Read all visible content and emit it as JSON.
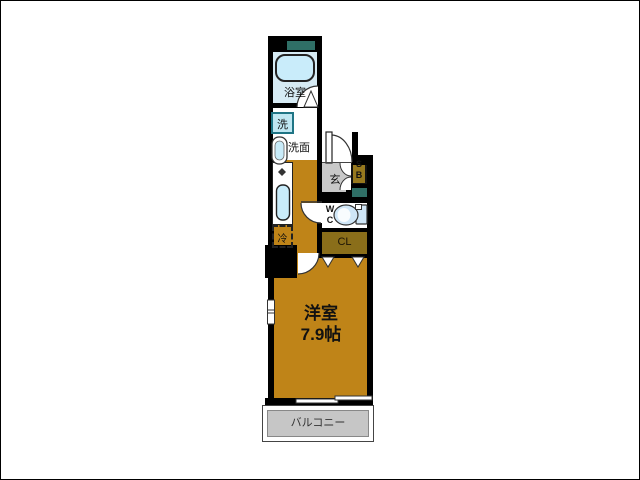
{
  "colors": {
    "wall": "#000000",
    "floor_orange": "#bf8418",
    "bathroom_blue": "#d6ebf4",
    "fixture_blue": "#c9ecfa",
    "washer_blue": "#bfe7f2",
    "washer_border": "#1f7585",
    "genkan_gray": "#c8c8c8",
    "balcony_gray": "#c6c6c6",
    "closet_olive": "#8a6e1a",
    "shoebox_olive": "#96781e",
    "teal_accent": "#2f6f66",
    "toilet_blue": "#cfe6f7",
    "line_dark": "#333333"
  },
  "floorplan": {
    "bathroom_label": "浴室",
    "washer_label": "洗",
    "vanity_label": "洗面",
    "entrance_label": "玄",
    "shoebox_line1": "S",
    "shoebox_line2": "B",
    "wc_line1": "W",
    "wc_line2": "C",
    "closet_label": "CL",
    "fridge_label": "冷",
    "main_room_name": "洋室",
    "main_room_size": "7.9帖",
    "balcony_label": "バルコニー"
  }
}
